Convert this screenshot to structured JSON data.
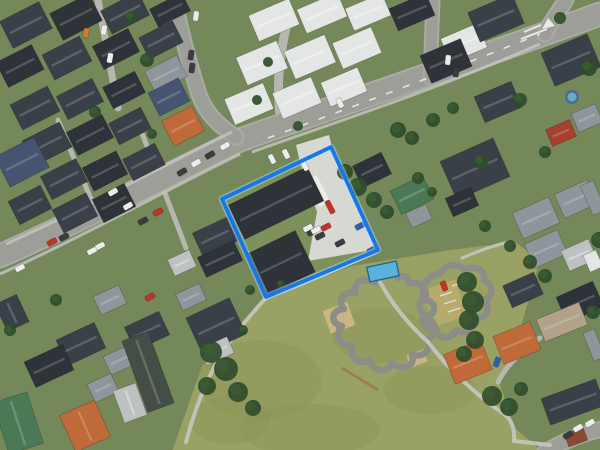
{
  "meta": {
    "view": "satellite-aerial-imagery",
    "scene": "suburban neighbourhood with highlighted property parcel and park with bike track",
    "width": 600,
    "height": 450
  },
  "colors": {
    "bg": "#75885a",
    "park": "#9aa164",
    "parkShade": "#8b9557",
    "road": "#9e9e99",
    "roadLight": "#ababa5",
    "lane": "#b7b7b1",
    "walk": "#c7c7c0",
    "concrete": "#d8d8d2",
    "marking": "#f2f2ec",
    "track": "#8d8d87",
    "parcelStroke": "#1578e6",
    "parcelHalo": "#bfdfff",
    "tree": "#2f4c2b",
    "tree2": "#3c5c34",
    "sand": "#cab684",
    "sandDark": "#b9a470",
    "tanGrass": "#b9ab6d",
    "beam": "#9b7c4e",
    "poolOuter": "#47708e",
    "poolInner": "#6aa9cc",
    "roofs": {
      "d": "#3a4047",
      "d2": "#2d3339",
      "m": "#8f969b",
      "w": "#e4e6e5",
      "lg": "#bdc1c1",
      "t": "#c06a3a",
      "n": "#46546f",
      "g": "#4a7a55",
      "gg": "#434f46",
      "tan": "#b2a289",
      "rs": "#a8402f",
      "rust": "#8a4a32",
      "ct": "#58b2dc"
    },
    "cars": {
      "wt": "#ececea",
      "dk": "#3c3c40",
      "rd": "#c03428",
      "bl": "#2f5fae",
      "or": "#d07a30"
    }
  },
  "parcel": {
    "label": "selected-property-boundary",
    "points": "331,147 222,199 266,297 378,250",
    "strokeWidth": 3.8
  },
  "parcelInterior": {
    "lawn": "329,150 226,200 267,294 376,249",
    "concrete": "296,145 329,135 333,151 378,249 308,261 317,212 302,170",
    "carport": [
      312,
      176,
      12,
      30,
      -27
    ]
  },
  "park": {
    "outline": "172,452 202,366 262,300 352,266 450,250 515,242 540,260 520,330 500,385 515,428 540,450",
    "mottle": [
      [
        260,
        380,
        62,
        40
      ],
      [
        310,
        430,
        70,
        26
      ],
      [
        380,
        335,
        48,
        28
      ],
      [
        230,
        420,
        40,
        24
      ],
      [
        430,
        390,
        46,
        24
      ]
    ]
  },
  "roads": {
    "main": [
      {
        "d": "M 0,256 C 90,216 185,166 240,140 C 330,108 440,72 600,14",
        "w": 21
      },
      {
        "d": "M 175,0 C 180,30 188,58 197,88 C 203,110 216,124 236,137",
        "w": 13
      },
      {
        "d": "M 433,0 L 430,78",
        "w": 11
      },
      {
        "d": "M 566,0 C 557,14 549,24 545,34",
        "w": 13
      },
      {
        "d": "M 545,452 C 566,440 584,433 602,429",
        "w": 13
      }
    ],
    "centerDashes": {
      "d": "M 268,138 C 350,108 450,70 540,34",
      "dash": "7,11"
    },
    "islandLines": [
      [
        521,
        39,
        547,
        29
      ],
      [
        524,
        32,
        541,
        25
      ]
    ],
    "islandTriangle": "548,18 555,26 542,29"
  },
  "walkways": [
    {
      "d": "M 6,244 C 90,206 170,162 232,132",
      "w": 3
    },
    {
      "d": "M 0,274 C 80,238 170,188 240,154",
      "w": 3
    },
    {
      "d": "M 252,152 C 330,124 430,92 540,44",
      "w": 3
    }
  ],
  "lanes": [
    {
      "d": "M 98,0 L 118,108",
      "w": 7
    },
    {
      "d": "M 58,120 L 98,216",
      "w": 5
    },
    {
      "d": "M 140,128 L 186,248",
      "w": 5
    },
    {
      "d": "M 282,128 C 276,96 278,62 286,28",
      "w": 9
    },
    {
      "d": "M 540,338 C 520,352 506,366 498,382",
      "w": 5
    }
  ],
  "parkPaths": [
    {
      "d": "M 186,442 C 198,398 214,360 240,328 C 252,314 258,306 265,299",
      "w": 4
    },
    {
      "d": "M 265,298 C 305,284 340,268 376,252",
      "w": 3
    },
    {
      "d": "M 380,282 C 392,304 408,324 428,342",
      "w": 4
    },
    {
      "d": "M 428,342 C 446,366 472,392 504,414 C 512,420 515,430 514,441",
      "w": 4
    },
    {
      "d": "M 514,441 L 550,445",
      "w": 4
    },
    {
      "d": "M 462,258 C 476,252 492,246 508,242",
      "w": 3
    }
  ],
  "track": {
    "loops": [
      "M 398,278 C 388,268 374,272 376,283 C 364,276 352,282 356,293 C 344,290 336,300 344,309 C 330,310 330,324 342,326 C 334,334 340,347 352,345 C 348,357 360,366 370,360 C 372,372 388,374 392,363 C 402,372 416,366 412,355 C 424,358 434,348 426,340 C 438,336 438,322 426,318 C 438,314 436,300 424,300 C 430,290 420,280 410,284 C 408,276 402,274 398,278 Z",
      "M 424,298 C 420,286 428,274 440,274 C 444,264 458,262 464,270 C 474,264 486,270 484,280 C 494,284 494,296 484,300 C 492,308 486,320 474,318 C 476,328 466,336 456,330 C 452,340 438,340 436,330 C 426,330 420,322 424,314 C 418,310 418,302 424,298 Z"
    ],
    "width": 6.5,
    "tanPatches": [
      [
        326,
        306,
        26,
        24,
        -20
      ],
      [
        408,
        352,
        18,
        13,
        -20
      ]
    ],
    "tanGrassPatch": [
      428,
      284,
      34,
      38,
      -18
    ],
    "whiteMarks": [
      [
        440,
        296,
        452,
        292
      ],
      [
        444,
        304,
        456,
        300
      ],
      [
        448,
        312,
        460,
        308
      ],
      [
        452,
        286,
        462,
        283
      ]
    ],
    "beam": [
      342,
      368,
      378,
      390
    ]
  },
  "buildings": [
    [
      4,
      10,
      44,
      30,
      -27,
      "d"
    ],
    [
      54,
      2,
      44,
      30,
      -27,
      "d2"
    ],
    [
      104,
      0,
      42,
      26,
      -27,
      "d"
    ],
    [
      152,
      0,
      36,
      20,
      -27,
      "d2"
    ],
    [
      0,
      52,
      40,
      28,
      -27,
      "d2"
    ],
    [
      46,
      44,
      42,
      28,
      -27,
      "d"
    ],
    [
      96,
      36,
      40,
      26,
      -27,
      "d2"
    ],
    [
      142,
      28,
      38,
      24,
      -27,
      "d"
    ],
    [
      14,
      94,
      42,
      28,
      -27,
      "d"
    ],
    [
      60,
      86,
      40,
      26,
      -27,
      "d"
    ],
    [
      106,
      78,
      36,
      24,
      -27,
      "d2"
    ],
    [
      148,
      62,
      36,
      24,
      -27,
      "m"
    ],
    [
      26,
      130,
      42,
      28,
      -27,
      "d"
    ],
    [
      70,
      122,
      40,
      26,
      -27,
      "d2"
    ],
    [
      112,
      114,
      36,
      24,
      -27,
      "d"
    ],
    [
      0,
      145,
      44,
      34,
      -27,
      "n"
    ],
    [
      44,
      166,
      40,
      26,
      -27,
      "d"
    ],
    [
      86,
      158,
      38,
      26,
      -27,
      "d2"
    ],
    [
      126,
      150,
      36,
      24,
      -27,
      "d"
    ],
    [
      152,
      84,
      34,
      26,
      -27,
      "n"
    ],
    [
      166,
      112,
      34,
      28,
      -27,
      "t"
    ],
    [
      12,
      192,
      36,
      26,
      -27,
      "d"
    ],
    [
      56,
      200,
      38,
      26,
      -27,
      "d"
    ],
    [
      96,
      190,
      36,
      26,
      -27,
      "d2"
    ],
    [
      0,
      298,
      24,
      30,
      -25,
      "d"
    ],
    [
      252,
      6,
      44,
      28,
      -23,
      "w"
    ],
    [
      300,
      0,
      44,
      26,
      -23,
      "w"
    ],
    [
      348,
      0,
      40,
      24,
      -23,
      "w"
    ],
    [
      240,
      48,
      44,
      30,
      -23,
      "w"
    ],
    [
      288,
      42,
      44,
      30,
      -23,
      "w"
    ],
    [
      336,
      34,
      42,
      28,
      -23,
      "w"
    ],
    [
      228,
      90,
      42,
      28,
      -23,
      "w"
    ],
    [
      276,
      84,
      42,
      28,
      -23,
      "w"
    ],
    [
      324,
      74,
      40,
      26,
      -23,
      "w"
    ],
    [
      392,
      0,
      40,
      24,
      -23,
      "d2"
    ],
    [
      444,
      30,
      40,
      26,
      -23,
      "w"
    ],
    [
      472,
      2,
      48,
      32,
      -23,
      "d"
    ],
    [
      546,
      42,
      50,
      36,
      -23,
      "d"
    ],
    [
      424,
      46,
      44,
      30,
      -23,
      "d2"
    ],
    [
      478,
      88,
      40,
      28,
      -23,
      "d"
    ],
    [
      574,
      108,
      26,
      20,
      -23,
      "m"
    ],
    [
      548,
      124,
      26,
      18,
      -23,
      "rs"
    ],
    [
      394,
      182,
      36,
      26,
      -26,
      "g"
    ],
    [
      446,
      148,
      58,
      42,
      -24,
      "d"
    ],
    [
      448,
      192,
      28,
      20,
      -24,
      "d2"
    ],
    [
      356,
      158,
      32,
      24,
      -26,
      "d2"
    ],
    [
      408,
      208,
      22,
      16,
      -24,
      "m"
    ],
    [
      516,
      204,
      40,
      28,
      -24,
      "m"
    ],
    [
      558,
      186,
      36,
      26,
      -24,
      "m"
    ],
    [
      586,
      182,
      14,
      32,
      -24,
      "m"
    ],
    [
      528,
      236,
      36,
      26,
      -24,
      "m"
    ],
    [
      564,
      244,
      30,
      22,
      -24,
      "lg"
    ],
    [
      506,
      278,
      34,
      24,
      -24,
      "d"
    ],
    [
      560,
      288,
      40,
      28,
      -24,
      "d2"
    ],
    [
      586,
      252,
      14,
      18,
      -24,
      "w"
    ],
    [
      196,
      224,
      38,
      26,
      -25,
      "d"
    ],
    [
      170,
      254,
      24,
      18,
      -25,
      "lg"
    ],
    [
      200,
      248,
      40,
      22,
      -25,
      "d2"
    ],
    [
      178,
      288,
      26,
      18,
      -25,
      "m"
    ],
    [
      192,
      306,
      48,
      40,
      -25,
      "d"
    ],
    [
      202,
      342,
      30,
      18,
      -25,
      "lg"
    ],
    [
      128,
      318,
      38,
      26,
      -25,
      "d"
    ],
    [
      96,
      290,
      28,
      20,
      -25,
      "m"
    ],
    [
      60,
      330,
      42,
      28,
      -25,
      "d"
    ],
    [
      28,
      352,
      42,
      28,
      -25,
      "d2"
    ],
    [
      90,
      378,
      26,
      20,
      -25,
      "m"
    ],
    [
      106,
      350,
      28,
      20,
      -25,
      "m"
    ],
    [
      118,
      386,
      24,
      34,
      -20,
      "lg"
    ],
    [
      134,
      334,
      28,
      76,
      -20,
      "gg"
    ],
    [
      0,
      396,
      36,
      54,
      -18,
      "g"
    ],
    [
      66,
      406,
      38,
      40,
      -24,
      "t"
    ],
    [
      448,
      346,
      40,
      32,
      -22,
      "t"
    ],
    [
      497,
      328,
      40,
      30,
      -22,
      "t"
    ],
    [
      539,
      310,
      46,
      24,
      -22,
      "tan"
    ],
    [
      544,
      388,
      58,
      28,
      -20,
      "d"
    ],
    [
      566,
      430,
      20,
      14,
      -20,
      "rust"
    ],
    [
      588,
      330,
      12,
      30,
      -22,
      "m"
    ],
    [
      232,
      184,
      88,
      38,
      -26,
      "d2"
    ],
    [
      254,
      240,
      54,
      46,
      -26,
      "d2"
    ]
  ],
  "trees": [
    [
      345,
      172,
      8
    ],
    [
      358,
      187,
      9
    ],
    [
      374,
      200,
      8
    ],
    [
      387,
      212,
      7
    ],
    [
      398,
      130,
      8
    ],
    [
      412,
      138,
      7
    ],
    [
      467,
      282,
      10
    ],
    [
      473,
      302,
      11
    ],
    [
      469,
      320,
      10
    ],
    [
      475,
      340,
      9
    ],
    [
      464,
      354,
      8
    ],
    [
      211,
      352,
      11
    ],
    [
      226,
      369,
      12
    ],
    [
      207,
      386,
      9
    ],
    [
      238,
      392,
      10
    ],
    [
      253,
      408,
      8
    ],
    [
      243,
      330,
      5
    ],
    [
      492,
      396,
      10
    ],
    [
      509,
      407,
      9
    ],
    [
      521,
      389,
      7
    ],
    [
      147,
      60,
      7
    ],
    [
      131,
      17,
      6
    ],
    [
      95,
      112,
      6
    ],
    [
      152,
      134,
      5
    ],
    [
      268,
      62,
      5
    ],
    [
      257,
      100,
      5
    ],
    [
      298,
      126,
      5
    ],
    [
      433,
      120,
      7
    ],
    [
      453,
      108,
      6
    ],
    [
      481,
      162,
      7
    ],
    [
      520,
      100,
      7
    ],
    [
      545,
      152,
      6
    ],
    [
      589,
      68,
      8
    ],
    [
      560,
      18,
      6
    ],
    [
      599,
      240,
      8
    ],
    [
      593,
      312,
      7
    ],
    [
      485,
      226,
      6
    ],
    [
      510,
      246,
      6
    ],
    [
      418,
      178,
      6
    ],
    [
      432,
      192,
      5
    ],
    [
      530,
      262,
      7
    ],
    [
      545,
      276,
      7
    ],
    [
      56,
      300,
      6
    ],
    [
      10,
      330,
      6
    ],
    [
      250,
      290,
      5
    ],
    [
      281,
      284,
      4
    ]
  ],
  "cars": [
    [
      225,
      146,
      60,
      "wt"
    ],
    [
      210,
      155,
      60,
      "dk"
    ],
    [
      196,
      163,
      60,
      "wt"
    ],
    [
      182,
      172,
      60,
      "dk"
    ],
    [
      128,
      206,
      60,
      "wt"
    ],
    [
      158,
      212,
      62,
      "rd"
    ],
    [
      143,
      221,
      62,
      "dk"
    ],
    [
      100,
      246,
      62,
      "wt"
    ],
    [
      92,
      251,
      62,
      "wt"
    ],
    [
      52,
      242,
      62,
      "rd"
    ],
    [
      64,
      237,
      62,
      "dk"
    ],
    [
      20,
      268,
      62,
      "wt"
    ],
    [
      113,
      192,
      60,
      "wt"
    ],
    [
      150,
      297,
      62,
      "rd"
    ],
    [
      340,
      103,
      -25,
      "wt"
    ],
    [
      448,
      60,
      5,
      "wt"
    ],
    [
      456,
      72,
      5,
      "dk"
    ],
    [
      196,
      16,
      8,
      "wt"
    ],
    [
      191,
      55,
      8,
      "dk"
    ],
    [
      192,
      68,
      8,
      "dk"
    ],
    [
      104,
      30,
      10,
      "wt"
    ],
    [
      86,
      33,
      10,
      "or"
    ],
    [
      110,
      58,
      10,
      "wt"
    ],
    [
      578,
      428,
      60,
      "wt"
    ],
    [
      590,
      423,
      60,
      "wt"
    ],
    [
      568,
      435,
      60,
      "dk"
    ],
    [
      330,
      207,
      -27,
      "rd",
      14
    ],
    [
      326,
      227,
      63,
      "rd"
    ],
    [
      312,
      232,
      63,
      "dk"
    ],
    [
      320,
      236,
      63,
      "dk"
    ],
    [
      340,
      243,
      63,
      "dk"
    ],
    [
      360,
      226,
      63,
      "bl"
    ],
    [
      372,
      250,
      63,
      "bl"
    ],
    [
      272,
      159,
      -27,
      "wt"
    ],
    [
      286,
      154,
      -27,
      "wt"
    ],
    [
      305,
      166,
      -27,
      "wt"
    ],
    [
      316,
      230,
      63,
      "wt"
    ],
    [
      308,
      228,
      63,
      "wt"
    ],
    [
      444,
      286,
      -20,
      "rd"
    ],
    [
      497,
      362,
      20,
      "bl"
    ]
  ],
  "pool": [
    572,
    97,
    7
  ],
  "container": [
    368,
    264,
    30,
    15,
    -12
  ]
}
